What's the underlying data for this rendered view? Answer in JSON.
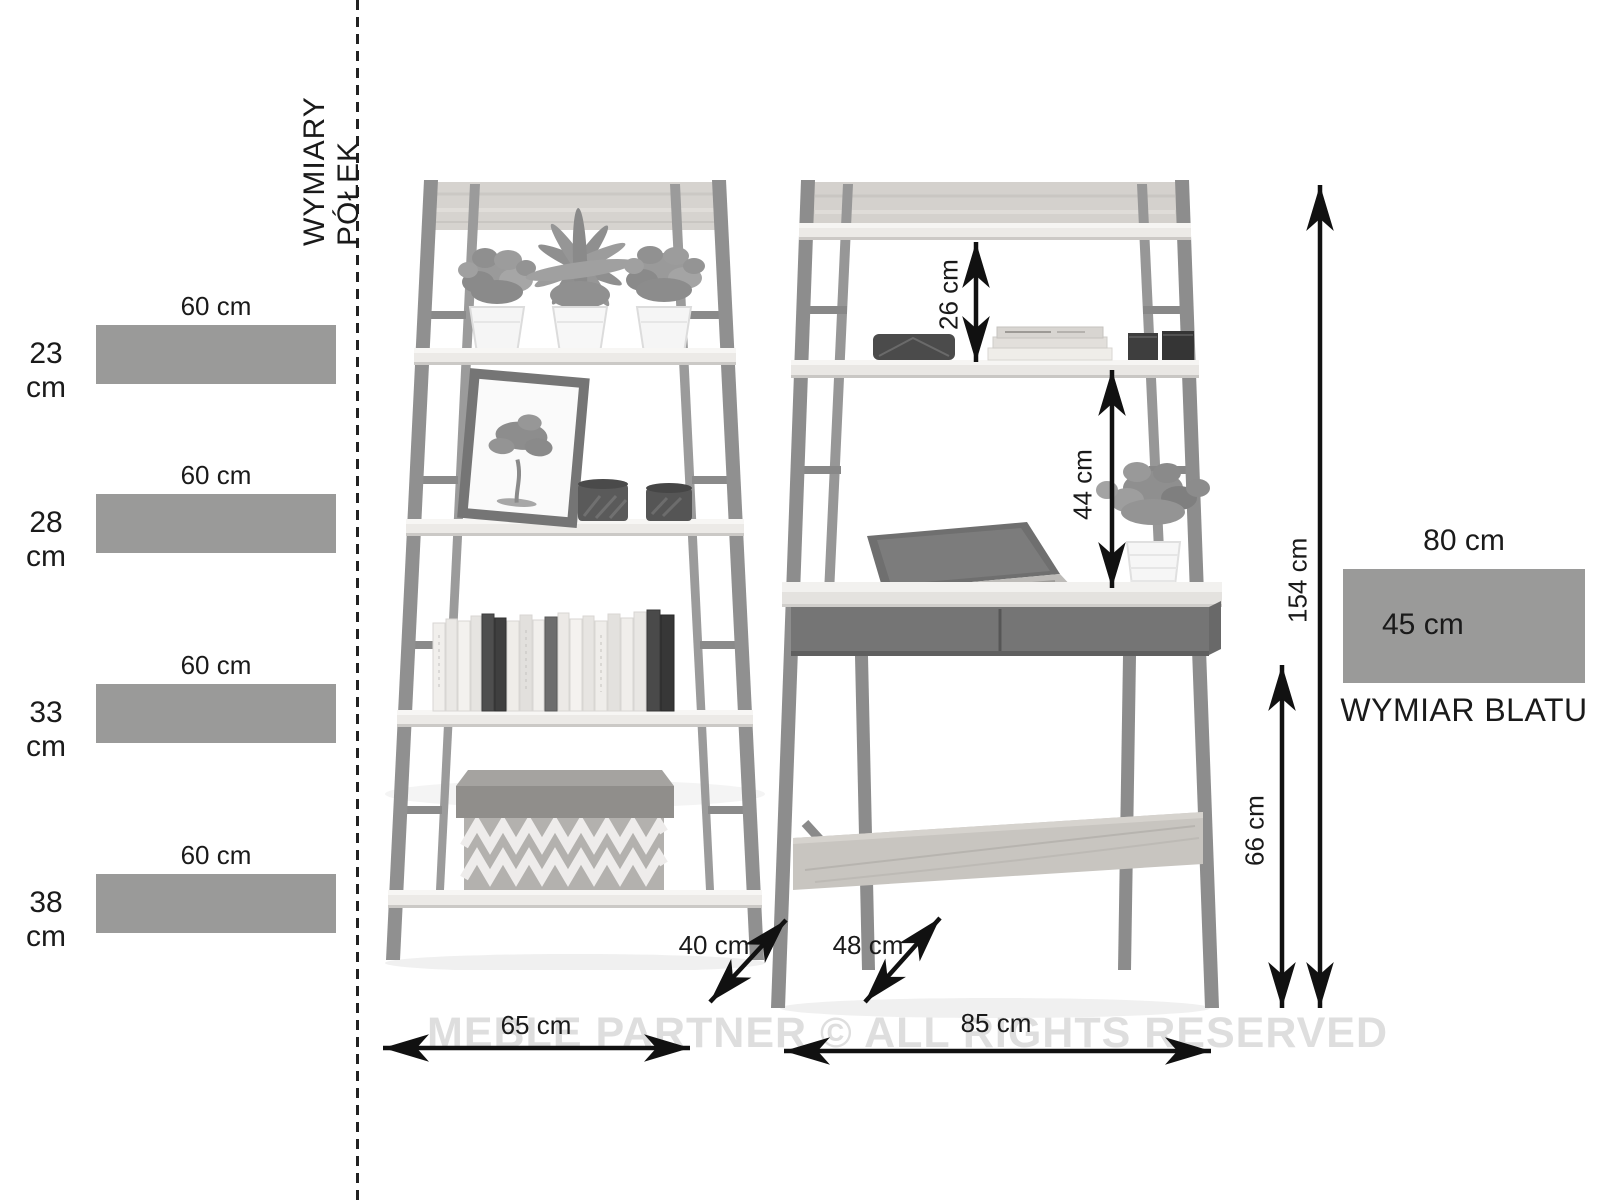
{
  "left_panel": {
    "title": "WYMIARY PÓŁEK",
    "bar_color": "#9a9a99",
    "rows": [
      {
        "top": "60 cm",
        "side": "23 cm"
      },
      {
        "top": "60 cm",
        "side": "28 cm"
      },
      {
        "top": "60 cm",
        "side": "33 cm"
      },
      {
        "top": "60 cm",
        "side": "38 cm"
      }
    ]
  },
  "bookshelf": {
    "width": "65 cm",
    "depth": "40 cm"
  },
  "desk": {
    "width": "85 cm",
    "depth": "48 cm",
    "height": "154 cm",
    "worktop_height": "66 cm",
    "hutch_shelf_gap": "26 cm",
    "worktop_clearance": "44 cm"
  },
  "worktop_panel": {
    "width": "80 cm",
    "depth": "45 cm",
    "caption": "WYMIAR BLATU",
    "bar_color": "#9a9a99"
  },
  "watermark": "MEBLE PARTNER © ALL RIGHTS RESERVED",
  "colors": {
    "arrow": "#111111",
    "text": "#1a1a1a",
    "watermark": "#dedede"
  }
}
